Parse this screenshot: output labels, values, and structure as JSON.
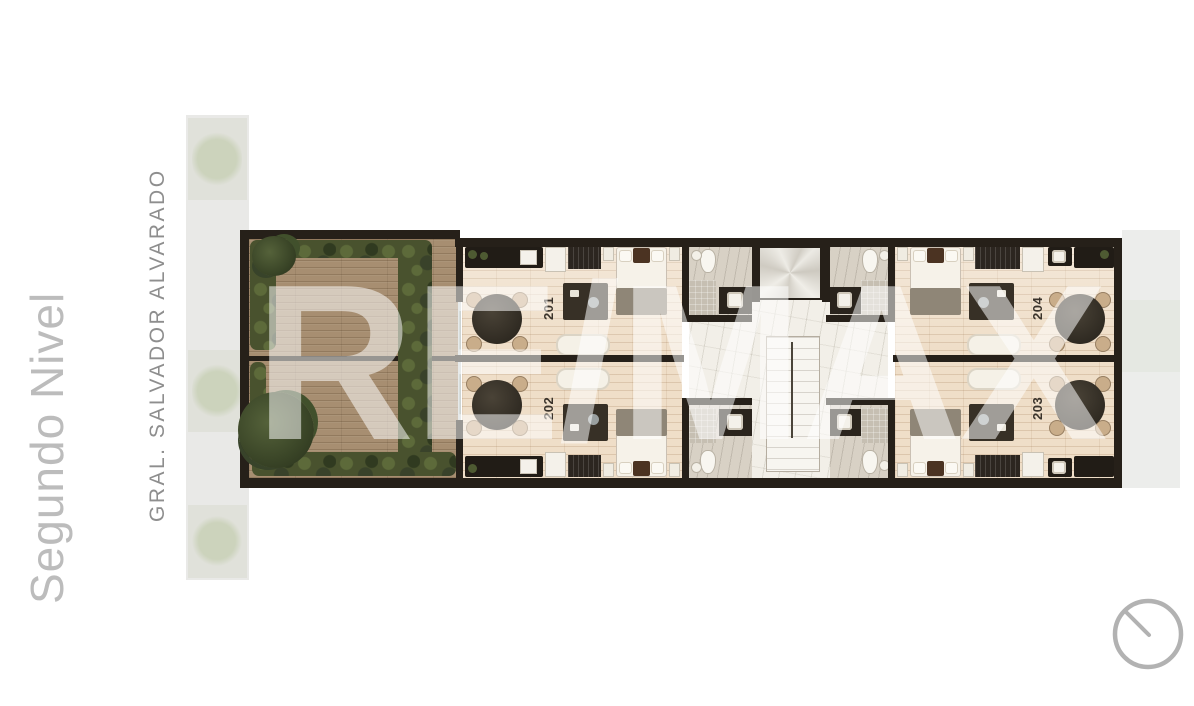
{
  "title": {
    "text": "Segundo Nivel",
    "color": "#bcbcbc"
  },
  "street": {
    "label": "GRAL. SALVADOR ALVARADO",
    "color": "#8e8e8e"
  },
  "watermark": {
    "text": "RE/MAX",
    "color": "rgba(255,255,255,0.53)"
  },
  "plan": {
    "units": [
      {
        "id": "201",
        "position": "upper-left"
      },
      {
        "id": "202",
        "position": "lower-left"
      },
      {
        "id": "203",
        "position": "lower-right"
      },
      {
        "id": "204",
        "position": "upper-right"
      }
    ],
    "features": [
      "terrace-deck",
      "planters",
      "elevator",
      "stairs",
      "bathrooms",
      "street-sidewalk-trees"
    ],
    "colors": {
      "wall": "#262019",
      "deck_wood": "#a78e71",
      "interior_floor": "#efdec8",
      "marble": "#f2efe8",
      "plants": "#49522e",
      "sidewalk": "#e9e9e7"
    }
  },
  "icons": {
    "compass": "compass-dial-icon"
  }
}
